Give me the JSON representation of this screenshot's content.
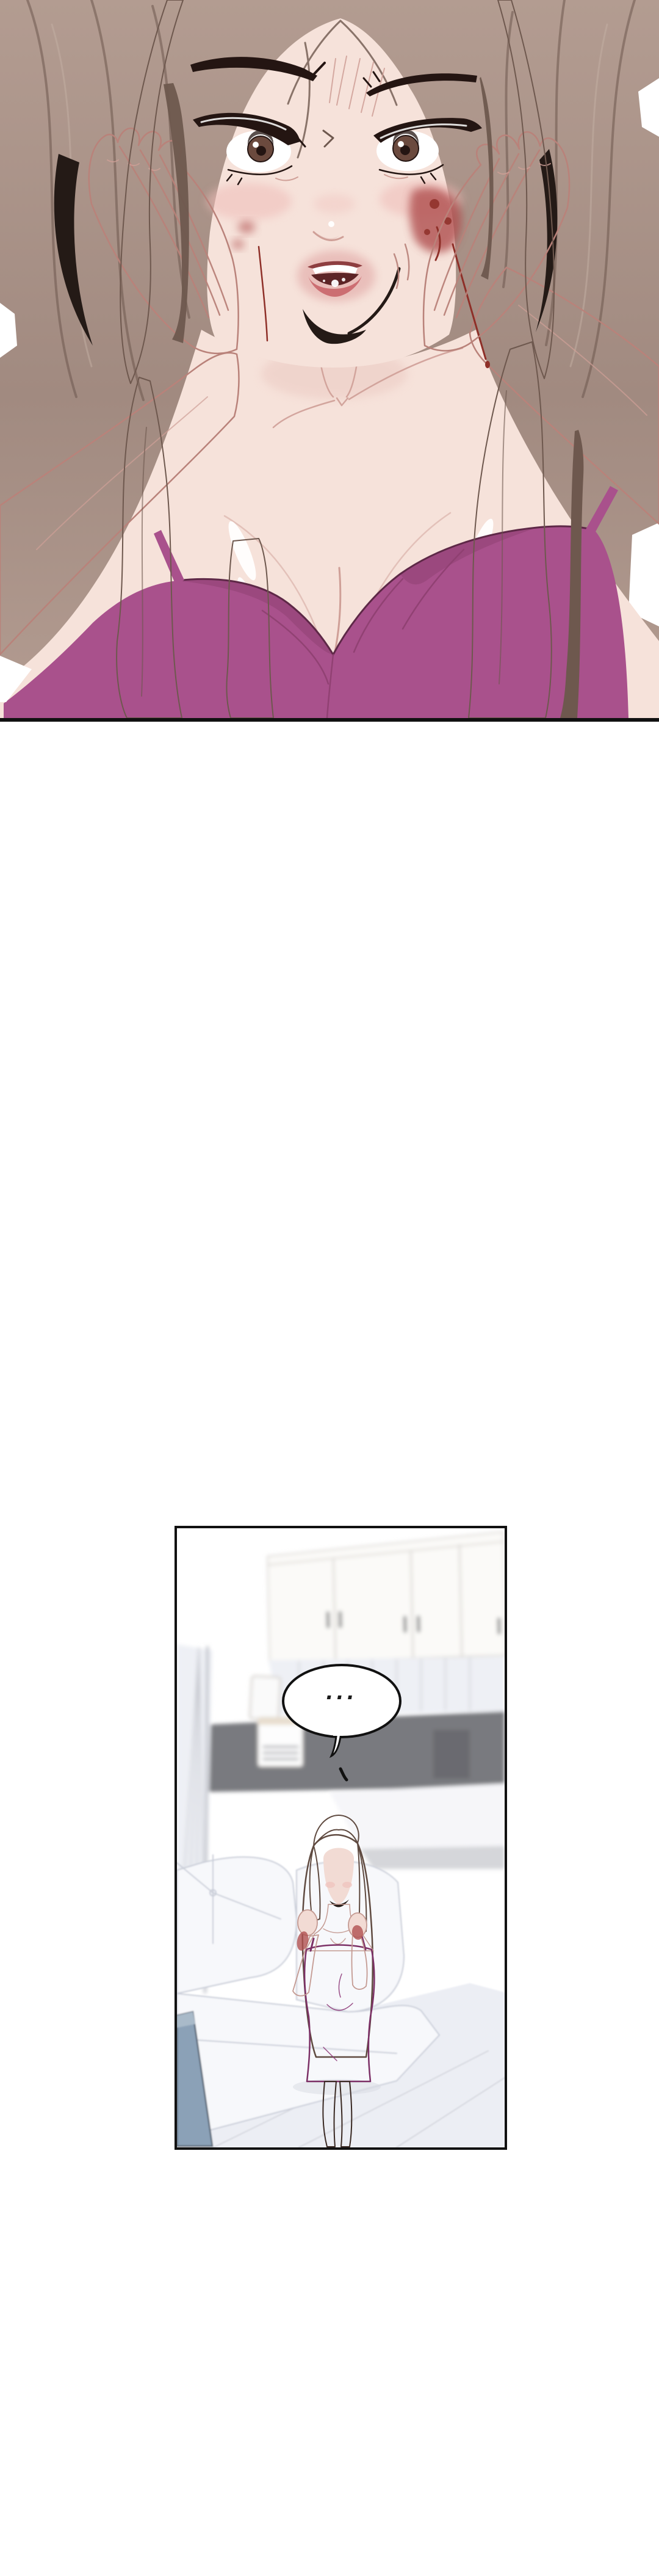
{
  "speech_bubble": {
    "text": "..."
  },
  "palette": {
    "paper": "#ffffff",
    "panel_border": "#111111",
    "hair_light": "#b39c91",
    "hair_mid": "#a18a80",
    "hair_dark": "#6e584e",
    "hair_hl": "#c3afa3",
    "hair_deep": "#241a16",
    "skin": "#f6e2da",
    "skin_shade": "#eac7c0",
    "skin_line": "#b9827a",
    "skin_soft": "#cf9f97",
    "blush": "#efbcb8",
    "lash": "#241512",
    "iris": "#6b4a3e",
    "lip": "#cc6e72",
    "lip_dark": "#8e3e40",
    "mouth": "#5d2426",
    "bruise": "#b05050",
    "blood": "#8e2f28",
    "cami": "#a9518c",
    "cami_dark": "#8d3f6f",
    "cami_line": "#5e2847",
    "dress": "#b14f9b",
    "dress_dark": "#7c3066",
    "w2_skin": "#f2dbd4",
    "w2_skin_line": "#c49a92",
    "w2_hair": "#9b7e70",
    "w2_hair_line": "#5f4a40",
    "room_counter": "#797a7f",
    "cabinet": "#fbfaf8",
    "cabinet_line": "#d6d2cd",
    "handle": "#9b9b9b",
    "curtain": "#eef0f5",
    "curtain_line": "#c6c8cf",
    "couch": "#f7f8fb",
    "couch_line": "#c9cdd8",
    "floor": "#eceef4",
    "floor_line": "#d5d7de",
    "blue_obj": "#8ba1b7",
    "blue_obj_dark": "#53606f",
    "bubble_fill": "#ffffff",
    "bubble_stroke": "#111111",
    "bubble_text": "#1a1a1a"
  }
}
